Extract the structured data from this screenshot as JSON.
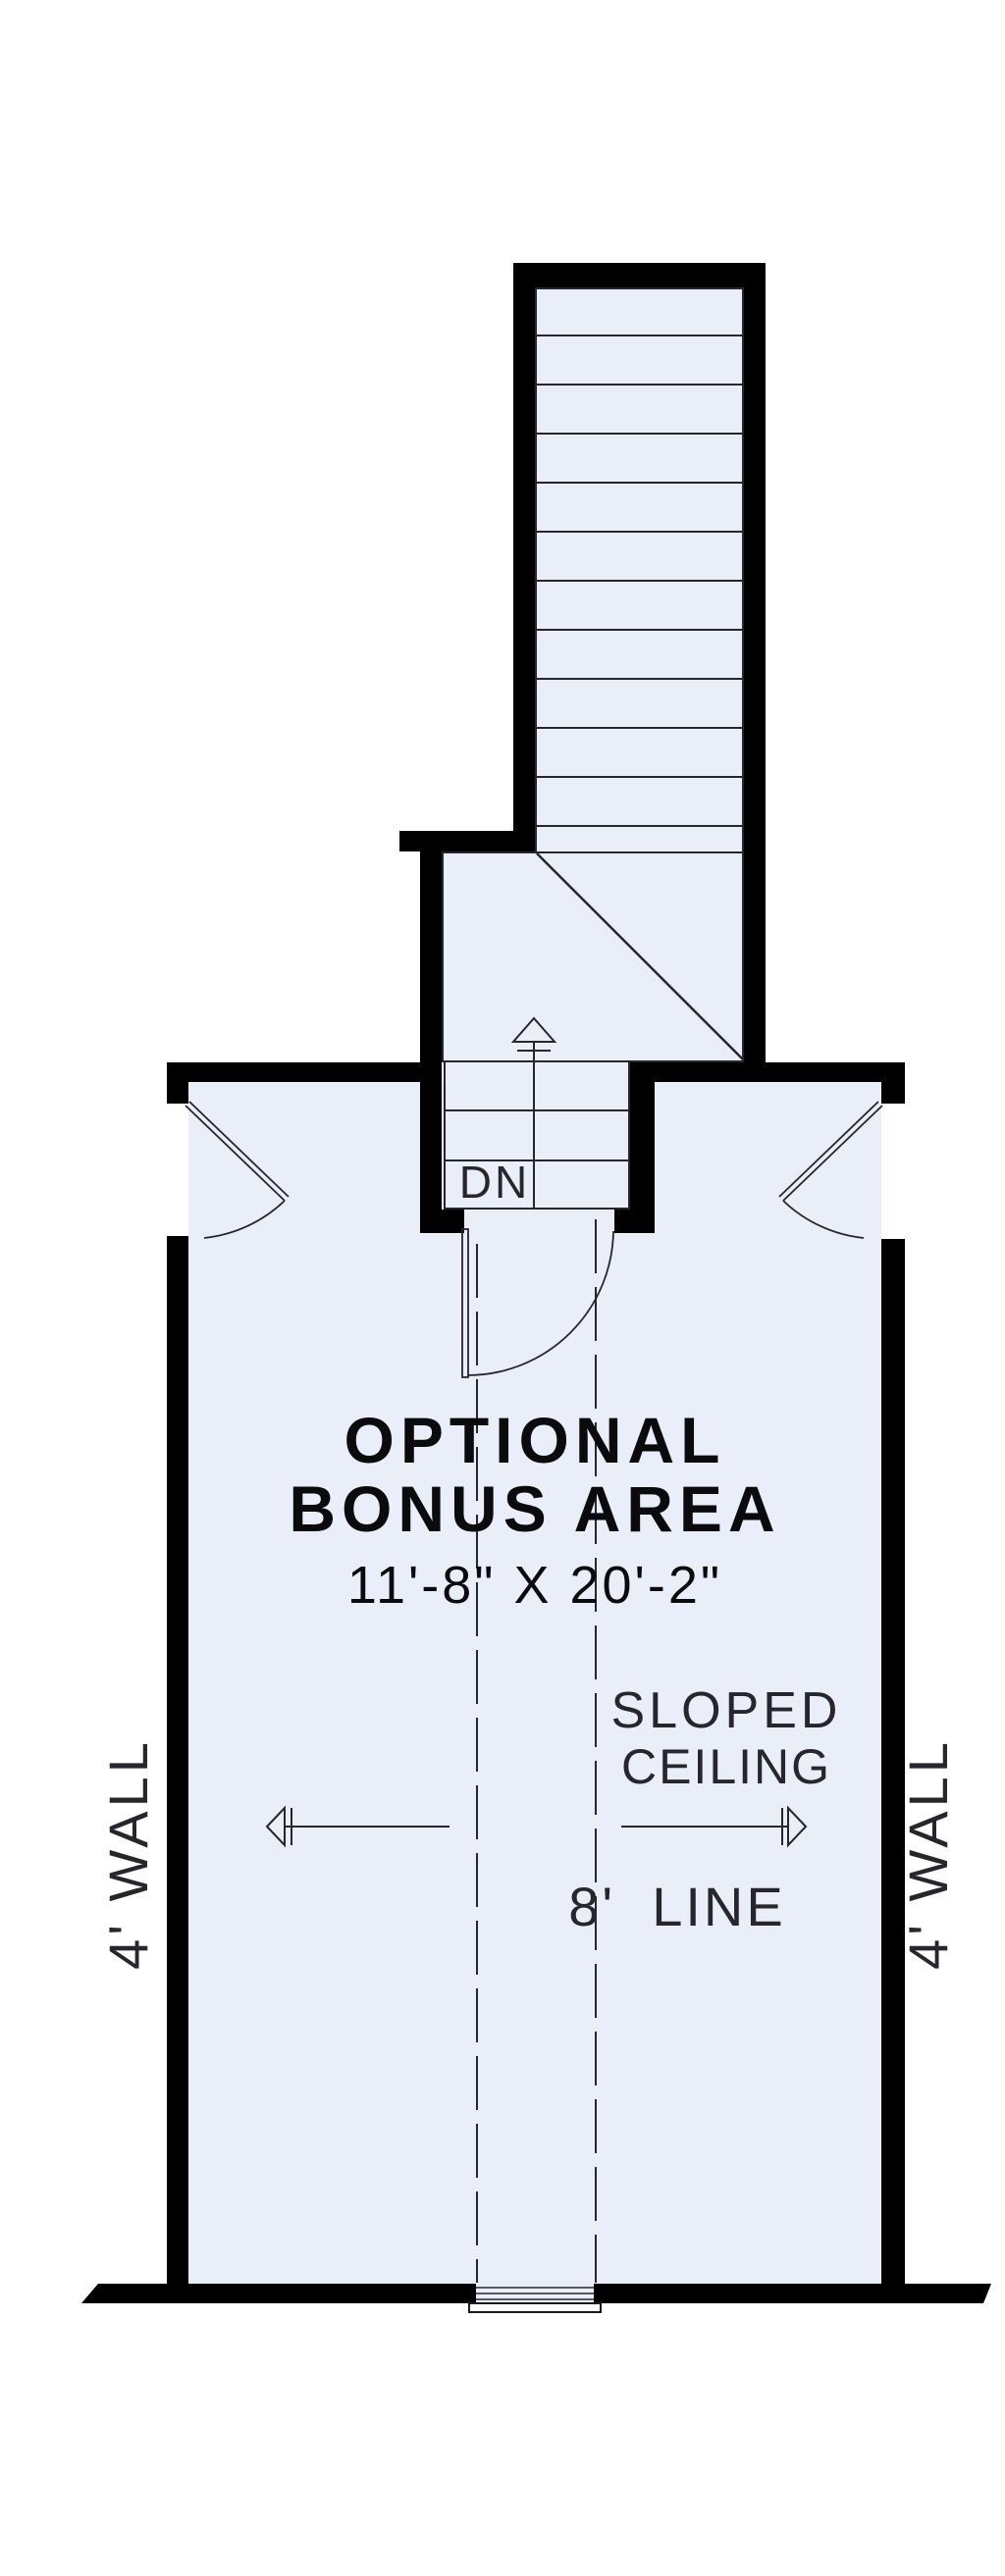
{
  "plan": {
    "room": {
      "title_line1": "OPTIONAL",
      "title_line2": "BONUS AREA",
      "dimensions": "11'-8\" X 20'-2\""
    },
    "annotations": {
      "sloped_line1": "SLOPED",
      "sloped_line2": "CEILING",
      "eight_line_label": "8'  LINE",
      "left_wall_label": "4' WALL",
      "right_wall_label": "4' WALL",
      "stair_direction_label": "DN"
    },
    "colors": {
      "background": "#ffffff",
      "floor_fill": "#e9eef9",
      "wall": "#000000",
      "linework": "#26262c",
      "heavy_text": "#0b0b0e",
      "light_text": "#26262c"
    }
  }
}
